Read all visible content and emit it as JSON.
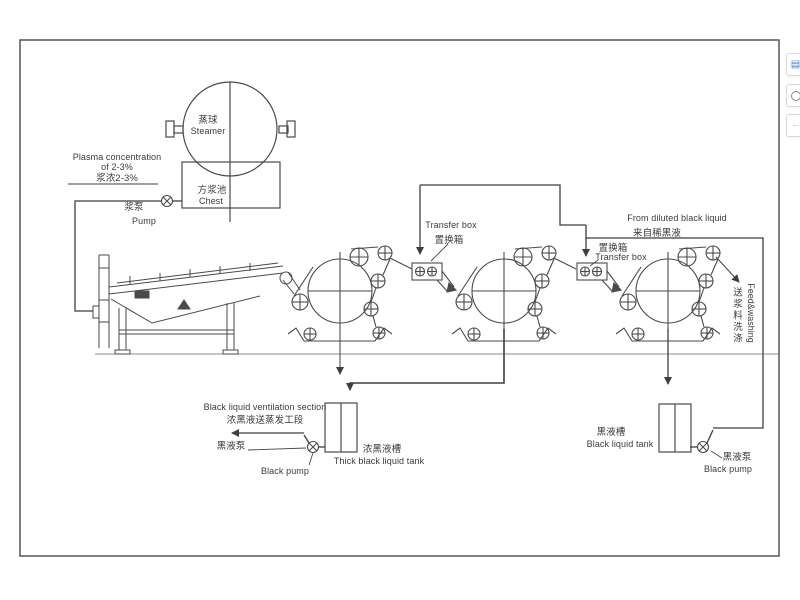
{
  "page": {
    "background": "#ffffff",
    "line_color": "#4a4a4a",
    "frame_color": "#555555",
    "text_color": "#3b3b3b"
  },
  "side_toolbar": {
    "buttons": [
      {
        "icon": "blue-document-icon"
      },
      {
        "icon": "clock-circle-icon"
      },
      {
        "icon": "more-dots-icon"
      }
    ]
  },
  "diagram": {
    "steamer": {
      "label_cn": "蒸球",
      "label_en": "Steamer"
    },
    "chest": {
      "label_cn": "方浆池",
      "label_en": "Chest"
    },
    "stock": {
      "line1": "Plasma concentration",
      "line2": "of 2-3%",
      "line3": "浆浓2-3%"
    },
    "stock_pump": {
      "label_cn": "浆泵",
      "label_en": "Pump"
    },
    "transfer_box_1": {
      "label_en": "Transfer box",
      "label_cn": "置换箱"
    },
    "transfer_box_2": {
      "label_cn": "置换箱",
      "label_en": "Transfer box"
    },
    "diluted_liquid": {
      "label_en": "From diluted black liquid",
      "label_cn": "来自稀黑液"
    },
    "feed_washing": {
      "label_en": "Feed&washing",
      "label_cn": "送浆料洗涤"
    },
    "evaporation": {
      "label_en": "Black liquid ventilation section",
      "label_cn": "浓黑液送蒸发工段"
    },
    "black_pump_left": {
      "label_cn": "黑液泵",
      "label_en": "Black pump"
    },
    "thick_black_tank": {
      "label_cn": "浓黑液槽",
      "label_en": "Thick black liquid tank"
    },
    "black_tank": {
      "label_cn": "黑液槽",
      "label_en": "Black liquid tank"
    },
    "black_pump_right": {
      "label_cn": "黑液泵",
      "label_en": "Black pump"
    }
  }
}
